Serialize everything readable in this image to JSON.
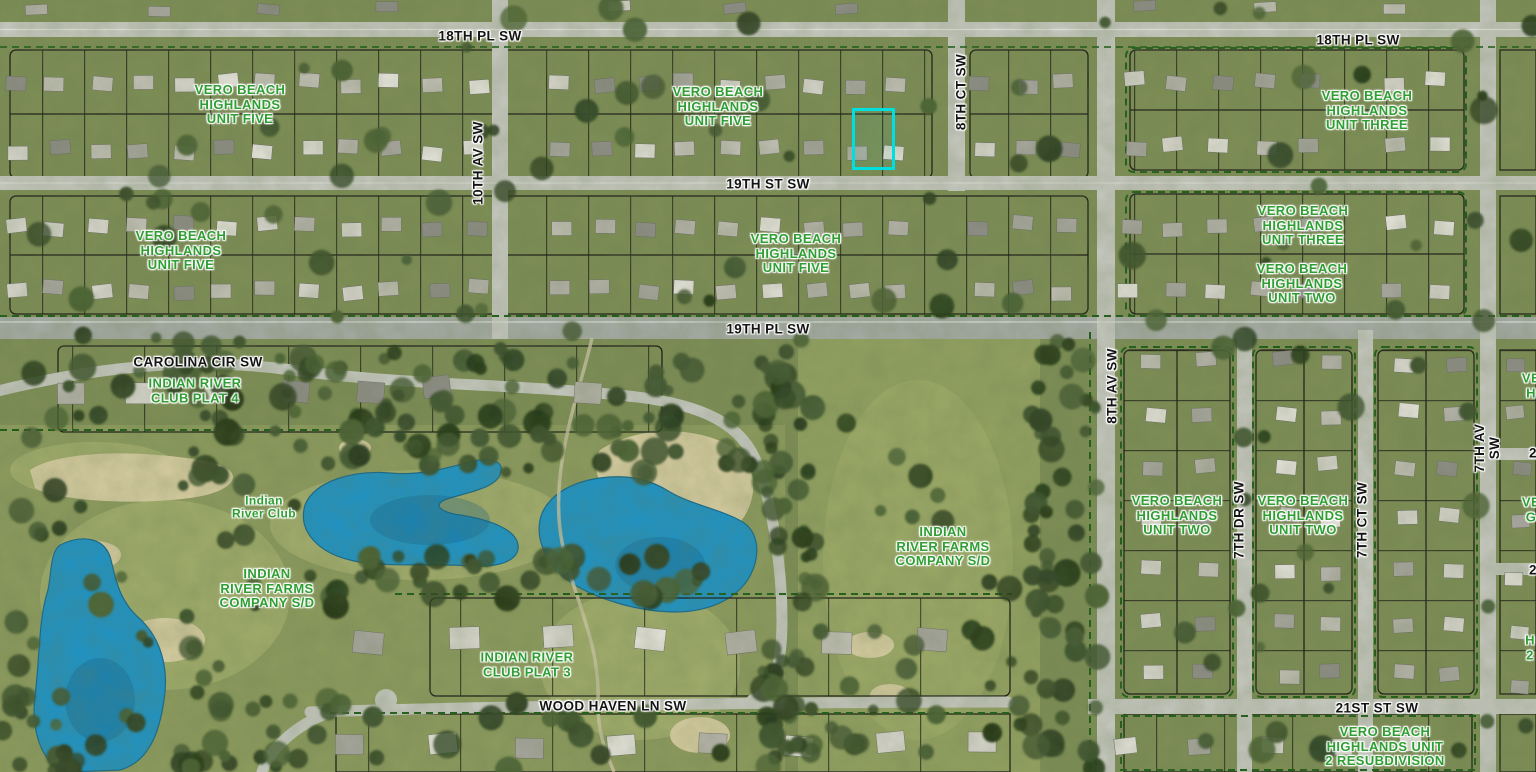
{
  "map": {
    "type": "aerial-parcel-map",
    "colors": {
      "water": "#1e93c6",
      "water_shadow": "#135f8a",
      "sand": "#d8cda2",
      "road": "#c7c9c1",
      "road_major": "#a7aca6",
      "grass_base": "#7e8e56",
      "fairway": "#9aa768",
      "parcel_line": "#1a1a14",
      "subdivision_boundary": "#1c5c16",
      "street_text": "#141414",
      "subdivision_text": "#2f9e33",
      "parcel_highlight": "#00dfdf"
    },
    "street_labels": [
      {
        "id": "18th-pl-sw-west",
        "text": "18TH PL SW"
      },
      {
        "id": "18th-pl-sw-east",
        "text": "18TH PL SW"
      },
      {
        "id": "19th-st-sw",
        "text": "19TH ST SW"
      },
      {
        "id": "19th-pl-sw",
        "text": "19TH PL SW"
      },
      {
        "id": "carolina-cir-sw",
        "text": "CAROLINA CIR SW"
      },
      {
        "id": "wood-haven-ln-sw",
        "text": "WOOD HAVEN LN SW"
      },
      {
        "id": "21st-st-sw",
        "text": "21ST ST SW"
      },
      {
        "id": "10th-av-sw",
        "text": "10TH AV SW"
      },
      {
        "id": "8th-ct-sw",
        "text": "8TH CT SW"
      },
      {
        "id": "8th-av-sw",
        "text": "8TH AV SW"
      },
      {
        "id": "7th-dr-sw",
        "text": "7TH DR SW"
      },
      {
        "id": "7th-ct-sw",
        "text": "7TH CT SW"
      },
      {
        "id": "7th-av-sw",
        "text": "7TH AV SW"
      }
    ],
    "subdivision_labels": [
      {
        "id": "vbh-unit-five-nw",
        "text": "VERO BEACH\nHIGHLANDS\nUNIT FIVE"
      },
      {
        "id": "vbh-unit-five-n",
        "text": "VERO BEACH\nHIGHLANDS\nUNIT FIVE"
      },
      {
        "id": "vbh-unit-five-w",
        "text": "VERO BEACH\nHIGHLANDS\nUNIT FIVE"
      },
      {
        "id": "vbh-unit-five-c",
        "text": "VERO BEACH\nHIGHLANDS\nUNIT FIVE"
      },
      {
        "id": "vbh-unit-three-ne",
        "text": "VERO BEACH\nHIGHLANDS\nUNIT THREE"
      },
      {
        "id": "vbh-unit-three-e",
        "text": "VERO BEACH\nHIGHLANDS\nUNIT THREE"
      },
      {
        "id": "vbh-unit-two-e",
        "text": "VERO BEACH\nHIGHLANDS\nUNIT TWO"
      },
      {
        "id": "irc-plat-4",
        "text": "INDIAN RIVER\nCLUB PLAT 4"
      },
      {
        "id": "indian-river-club",
        "text": "Indian\nRiver Club"
      },
      {
        "id": "irf-company-sd-w",
        "text": "INDIAN\nRIVER FARMS\nCOMPANY S/D"
      },
      {
        "id": "irf-company-sd-e",
        "text": "INDIAN\nRIVER FARMS\nCOMPANY S/D"
      },
      {
        "id": "irc-plat-3",
        "text": "INDIAN RIVER\nCLUB PLAT 3"
      },
      {
        "id": "vbh-unit-two-s1",
        "text": "VERO BEACH\nHIGHLANDS\nUNIT TWO"
      },
      {
        "id": "vbh-unit-two-s2",
        "text": "VERO BEACH\nHIGHLANDS\nUNIT TWO"
      },
      {
        "id": "vbh-unit-2-resub",
        "text": "VERO BEACH\nHIGHLANDS UNIT\n2 RESUBDIVISION"
      }
    ],
    "edge_fragments": [
      {
        "id": "frag-sub-1",
        "text": "VE\nH",
        "kind": "subdivision"
      },
      {
        "id": "frag-street-1",
        "text": "2",
        "kind": "street"
      },
      {
        "id": "frag-sub-2",
        "text": "VE\nG",
        "kind": "subdivision"
      },
      {
        "id": "frag-street-2",
        "text": "2",
        "kind": "street"
      },
      {
        "id": "frag-sub-3",
        "text": "H\n2",
        "kind": "subdivision"
      }
    ],
    "selected_parcel": {
      "highlight_color": "#00dfdf",
      "location": "north side of 19TH ST SW, west of 8TH CT SW"
    }
  }
}
